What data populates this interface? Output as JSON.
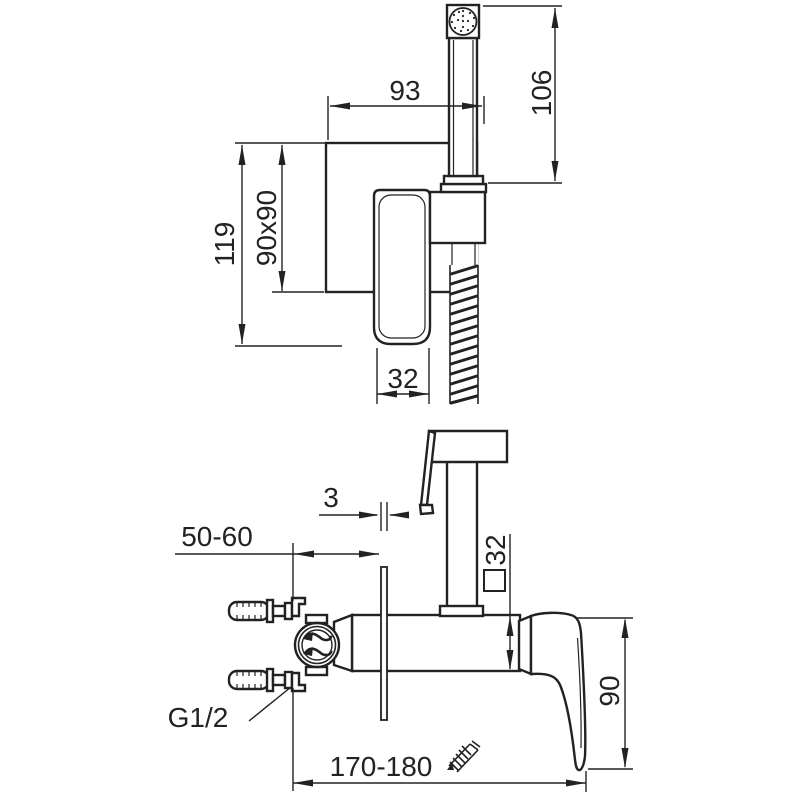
{
  "meta": {
    "description": "Technical dimension drawing of a wall-mounted hygienic shower bidet mixer: front view (top) and side installation view (bottom)",
    "background": "#ffffff",
    "line_color": "#222222",
    "style_vars": "--line:#222222;--bg:#ffffff"
  },
  "front_view": {
    "dim_plate_to_holder": "93",
    "dim_sprayer_height": "106",
    "dim_overall_height": "119",
    "dim_plate_size": "90x90",
    "dim_handle_width": "32"
  },
  "side_view": {
    "dim_plate_thickness": "3",
    "dim_wall_to_plate": "50-60",
    "dim_body_section": "32",
    "dim_handle_drop": "90",
    "dim_wall_to_handle": "170-180",
    "thread_label": "G1/2"
  }
}
